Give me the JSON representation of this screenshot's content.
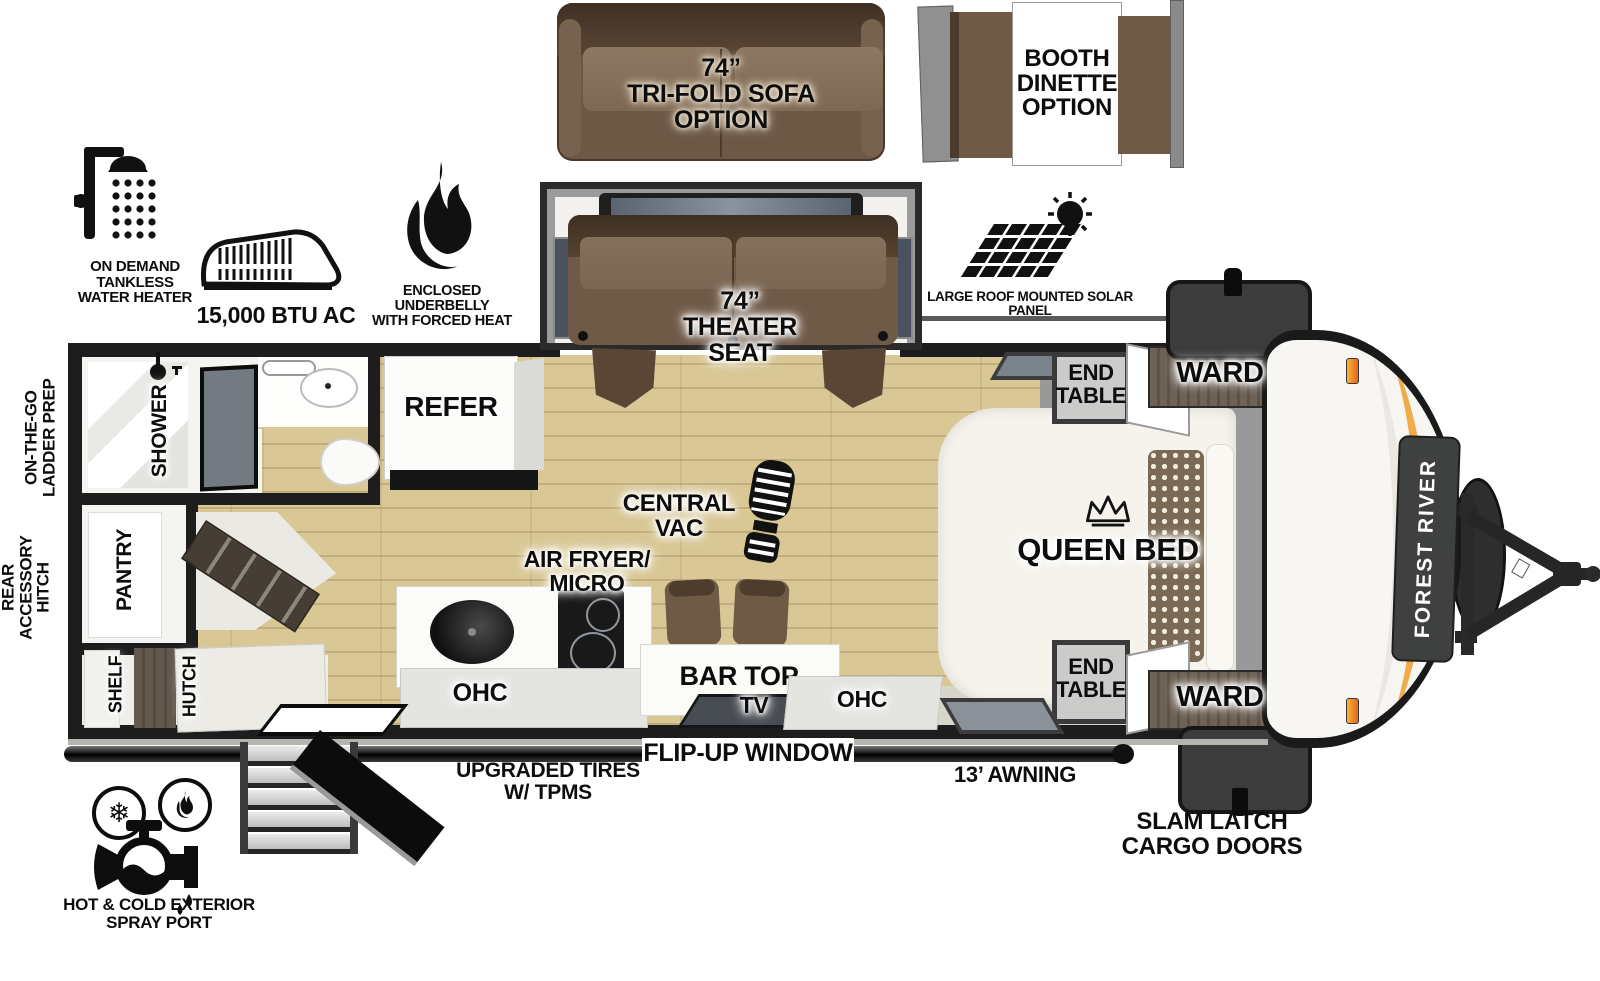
{
  "brand": "FOREST RIVER",
  "options": {
    "trifold_sofa": [
      "74”",
      "TRI-FOLD SOFA",
      "OPTION"
    ],
    "booth_dinette": [
      "BOOTH",
      "DINETTE",
      "OPTION"
    ]
  },
  "features": {
    "water_heater": [
      "ON DEMAND",
      "TANKLESS",
      "WATER HEATER"
    ],
    "ac": "15,000 BTU AC",
    "underbelly": [
      "ENCLOSED UNDERBELLY",
      "WITH FORCED HEAT"
    ],
    "solar": [
      "LARGE ROOF MOUNTED SOLAR PANEL",
      "30 AMP CONTROLLER & INVERTER PREP"
    ]
  },
  "interior": {
    "theater_seat": [
      "74”",
      "THEATER",
      "SEAT"
    ],
    "queen_bed": "QUEEN BED",
    "end_table_top": [
      "END",
      "TABLE"
    ],
    "end_table_bottom": [
      "END",
      "TABLE"
    ],
    "ward_top": "WARD",
    "ward_bottom": "WARD",
    "refer": "REFER",
    "shower": "SHOWER",
    "pantry": "PANTRY",
    "shelf": "SHELF",
    "hutch": "HUTCH",
    "central_vac": [
      "CENTRAL",
      "VAC"
    ],
    "air_fryer_micro": [
      "AIR FRYER/",
      "MICRO"
    ],
    "ohc_left": "OHC",
    "bar_top": "BAR TOP",
    "tv": "TV",
    "ohc_right": "OHC"
  },
  "exterior": {
    "flip_up_window": "FLIP-UP WINDOW",
    "upgraded_tires": [
      "UPGRADED TIRES",
      "W/ TPMS"
    ],
    "awning": "13’ AWNING",
    "slam_latch": [
      "SLAM LATCH",
      "CARGO DOORS"
    ],
    "spray_port": [
      "HOT & COLD EXTERIOR",
      "SPRAY PORT"
    ],
    "ladder_prep": [
      "ON-THE-GO",
      "LADDER PREP"
    ],
    "rear_hitch": [
      "REAR",
      "ACCESSORY",
      "HITCH"
    ]
  },
  "colors": {
    "wall": "#1d1d1d",
    "wood_floor": "#d9c795",
    "sofa_brown": "#6d5846",
    "accent_orange": "#f0a43c",
    "slide_gray": "#9b9b9b"
  }
}
